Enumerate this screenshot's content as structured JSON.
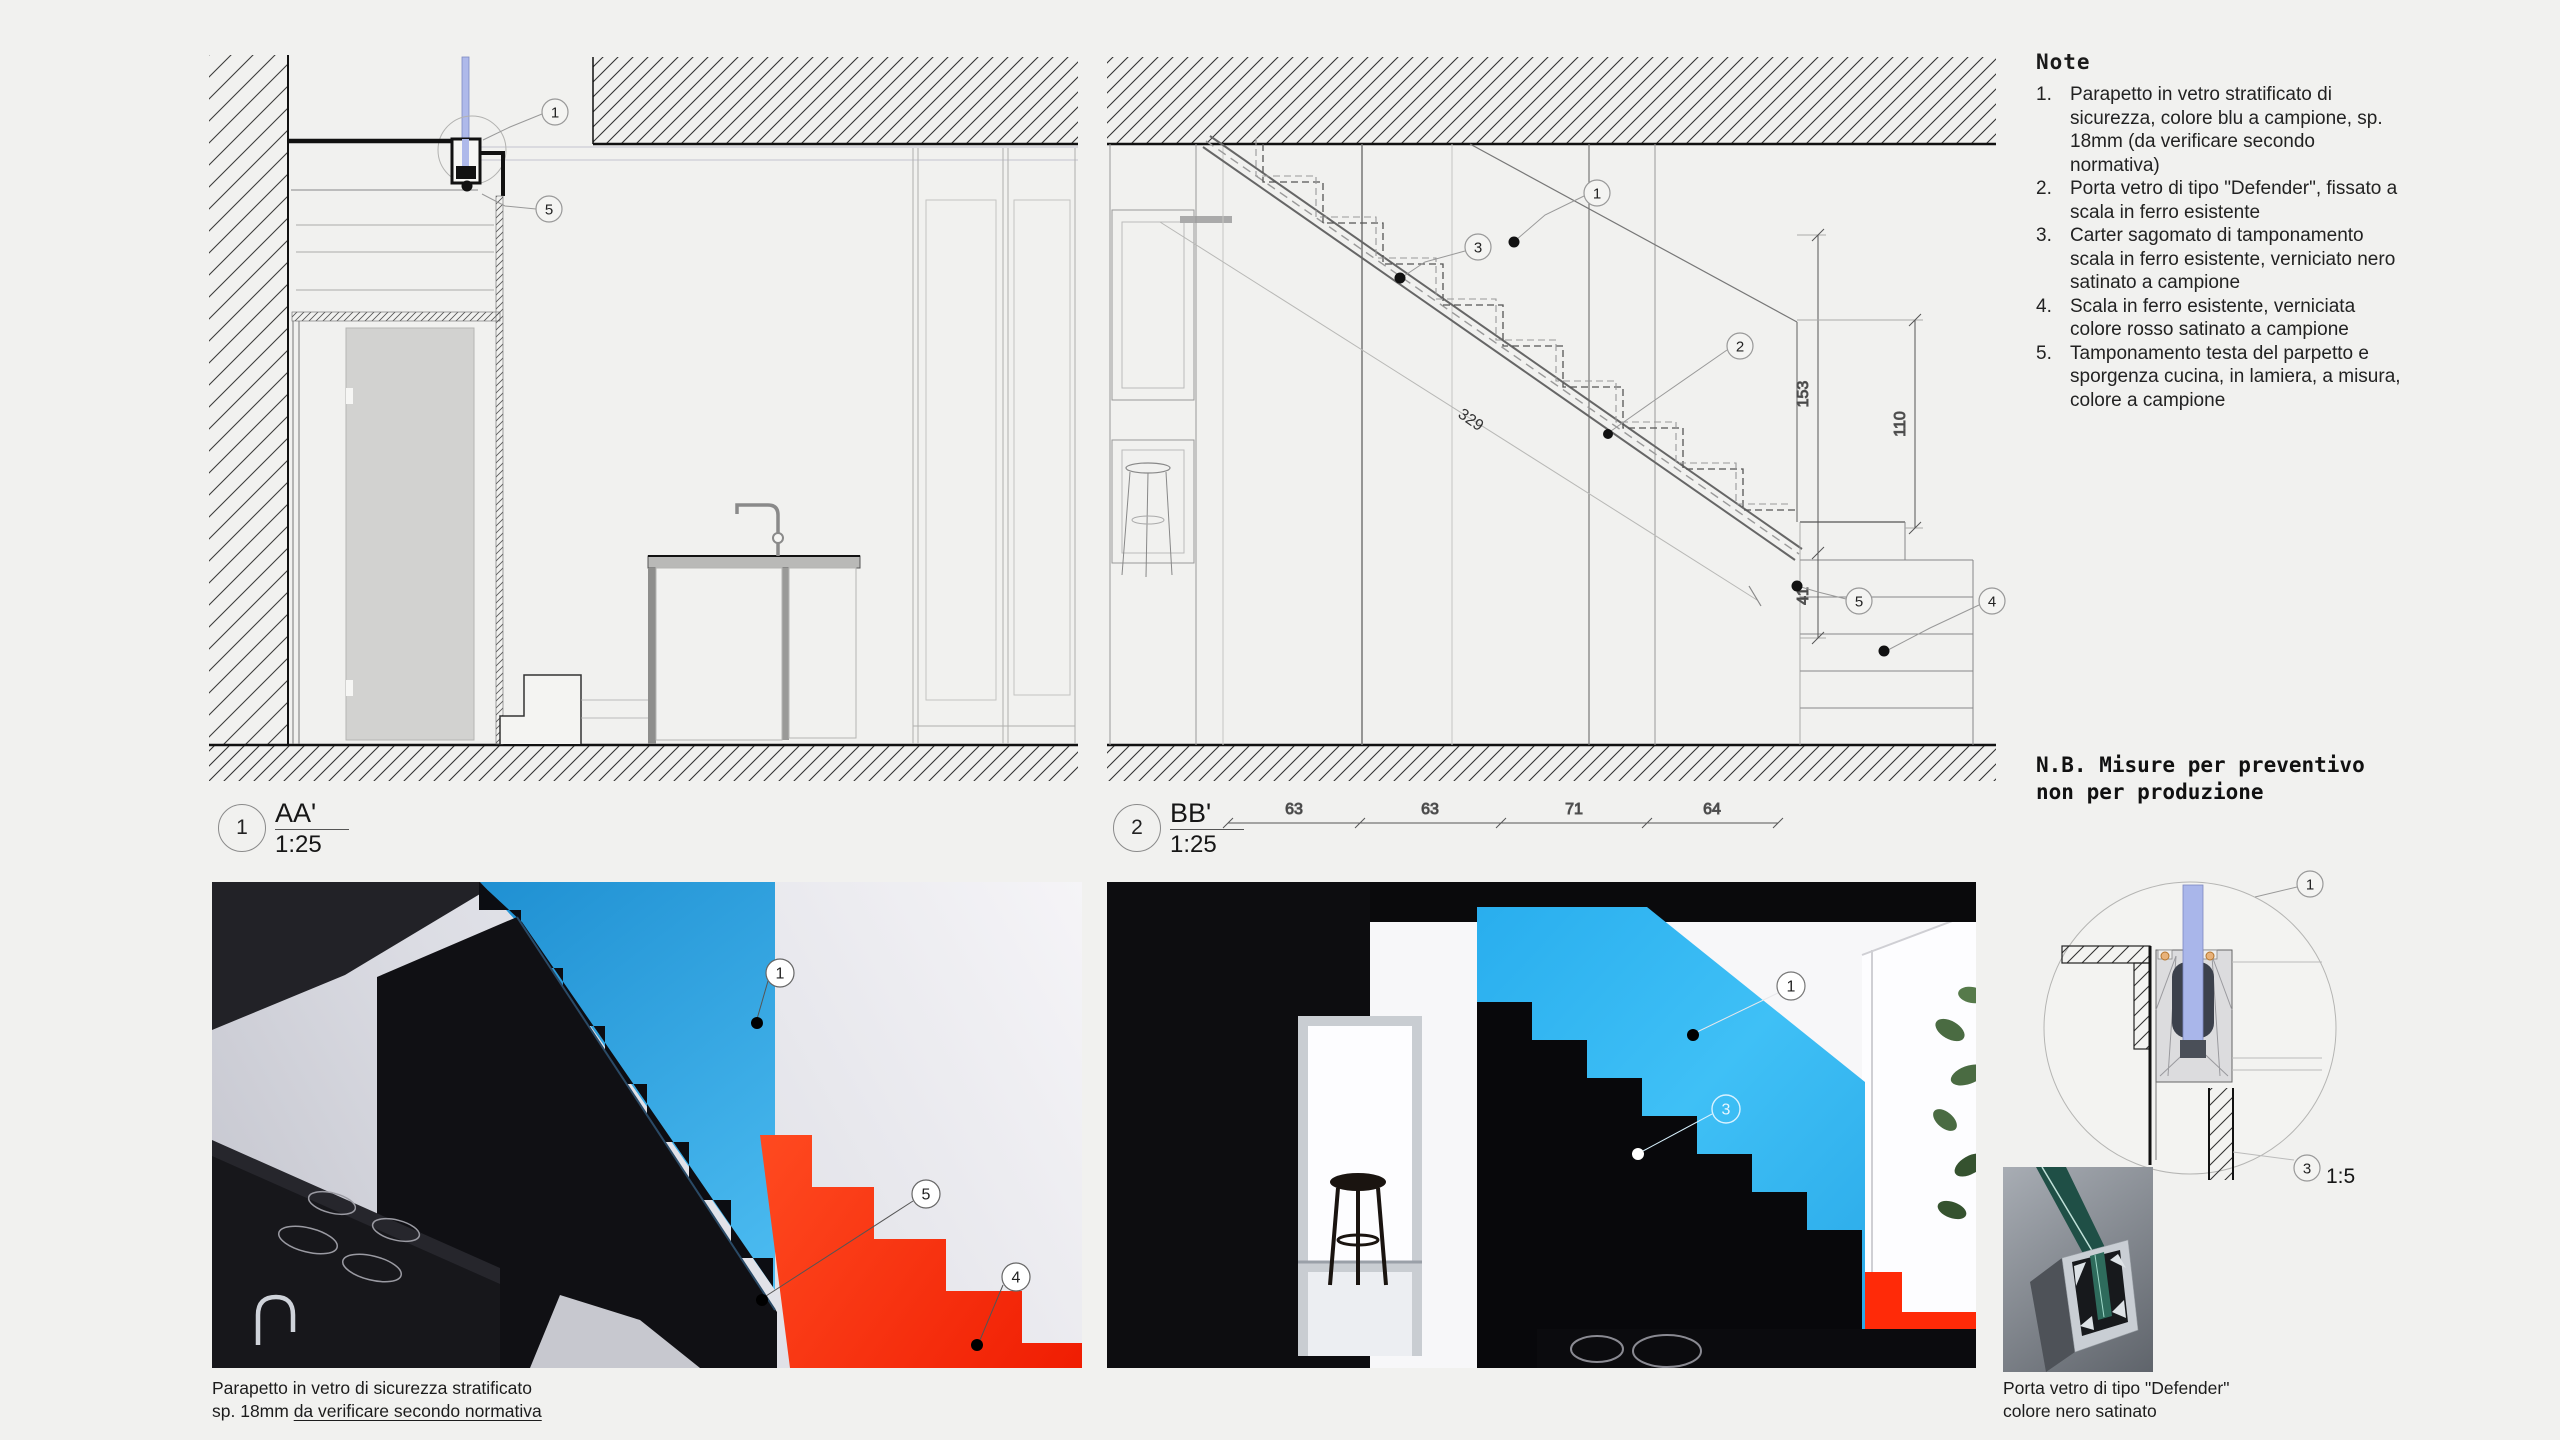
{
  "sheet": {
    "bg": "#f1f1ef",
    "line_color": "#333333"
  },
  "notes": {
    "title": "Note",
    "items": [
      {
        "num": "1.",
        "text": "Parapetto in vetro stratificato di sicurezza, colore blu a campione, sp. 18mm (da verificare secondo normativa)"
      },
      {
        "num": "2.",
        "text": "Porta vetro di tipo \"Defender\", fissato a scala in ferro esistente"
      },
      {
        "num": "3.",
        "text": "Carter sagomato di tamponamento scala in ferro esistente, verniciato nero satinato a campione"
      },
      {
        "num": "4.",
        "text": "Scala in ferro esistente, verniciata colore rosso satinato a campione"
      },
      {
        "num": "5.",
        "text": "Tamponamento testa del parpetto e sporgenza cucina, in lamiera, a misura, colore a campione"
      }
    ]
  },
  "nb": {
    "line1": "N.B. Misure per preventivo",
    "line2": "non per produzione"
  },
  "sections": [
    {
      "num": "1",
      "name": "AA'",
      "scale": "1:25"
    },
    {
      "num": "2",
      "name": "BB'",
      "scale": "1:25"
    }
  ],
  "detail": {
    "num": "3",
    "scale": "1:5"
  },
  "callout_numbers": {
    "n1": "1",
    "n2": "2",
    "n3": "3",
    "n4": "4",
    "n5": "5"
  },
  "dimensions": {
    "bb_bottom": [
      "63",
      "63",
      "71",
      "64"
    ],
    "bb_diagonal": "329",
    "bb_heights": [
      "153",
      "110",
      "41"
    ]
  },
  "captions": {
    "photo1_line1": "Parapetto in vetro di sicurezza stratificato",
    "photo1_line2_prefix": "sp. 18mm ",
    "photo1_line2_underlined": "da verificare secondo normativa",
    "product_line1": "Porta vetro di tipo \"Defender\"",
    "product_line2": "colore nero satinato"
  },
  "colors": {
    "glass_drawing": "#aab6ea",
    "render_parapet_blue": "#2bb2ef",
    "render_stair_red": "#ff2a0a",
    "render_black": "#0d0d11"
  }
}
